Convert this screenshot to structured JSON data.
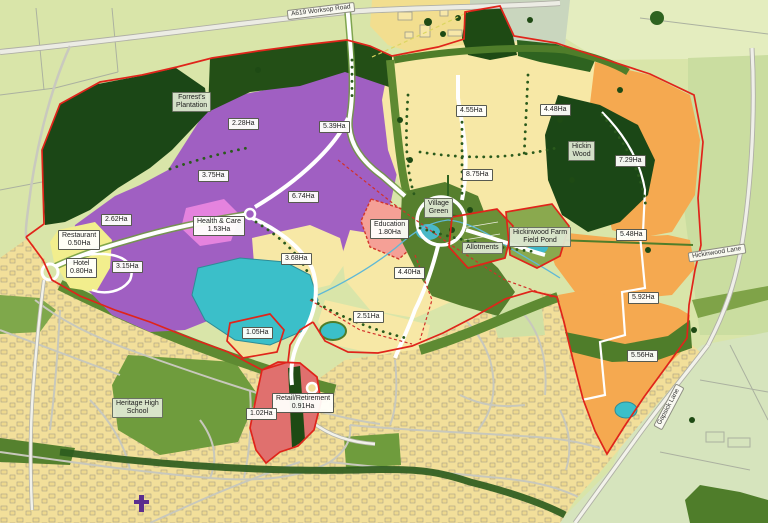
{
  "labels": {
    "roads": [
      {
        "name": "a619-worksop-road",
        "text": "A619 Worksop Road"
      },
      {
        "name": "hickinwood-lane",
        "text": "Hickinwood Lane"
      },
      {
        "name": "gapsick-lane",
        "text": "Gapsick Lane"
      }
    ],
    "places": [
      {
        "name": "forrests-plantation",
        "text": "Forrest's\nPlantation"
      },
      {
        "name": "hickin-wood",
        "text": "Hickin\nWood"
      },
      {
        "name": "village-green",
        "text": "Village\nGreen"
      },
      {
        "name": "allotments",
        "text": "Allotments"
      },
      {
        "name": "hickinwood-farm-field-pond",
        "text": "Hickinwood Farm\nField Pond"
      },
      {
        "name": "heritage-high-school",
        "text": "Heritage High\nSchool"
      }
    ],
    "parcels": [
      {
        "text": "2.28Ha"
      },
      {
        "text": "5.39Ha"
      },
      {
        "text": "3.75Ha"
      },
      {
        "text": "6.74Ha"
      },
      {
        "text": "2.62Ha"
      },
      {
        "text": "Restaurant\n0.50Ha"
      },
      {
        "text": "Hotel\n0.80Ha"
      },
      {
        "text": "3.15Ha"
      },
      {
        "text": "Health & Care\n1.53Ha"
      },
      {
        "text": "3.68Ha"
      },
      {
        "text": "4.55Ha"
      },
      {
        "text": "4.48Ha"
      },
      {
        "text": "8.75Ha"
      },
      {
        "text": "Education\n1.80Ha"
      },
      {
        "text": "4.40Ha"
      },
      {
        "text": "7.29Ha"
      },
      {
        "text": "5.48Ha"
      },
      {
        "text": "5.92Ha"
      },
      {
        "text": "5.56Ha"
      },
      {
        "text": "1.05Ha"
      },
      {
        "text": "2.51Ha"
      },
      {
        "text": "Retail/Retirement\n0.91Ha"
      },
      {
        "text": "1.02Ha"
      }
    ]
  },
  "palette": {
    "site_boundary_red": "#E0241A",
    "residential_purple": "#A05FC2",
    "village_cream": "#F7E8A6",
    "east_parcel_orange": "#F5A950",
    "hotel_yellow": "#F2EE8D",
    "health_care_pink": "#E583DE",
    "education_salmon": "#F5A096",
    "retail_red": "#E0706E",
    "woodland_dark_green": "#1E4A14",
    "green_space": "#5E8A32",
    "water_teal": "#3BBFC9",
    "urban_yellow": "#F2DF9A",
    "field_green": "#D9E5A9"
  }
}
